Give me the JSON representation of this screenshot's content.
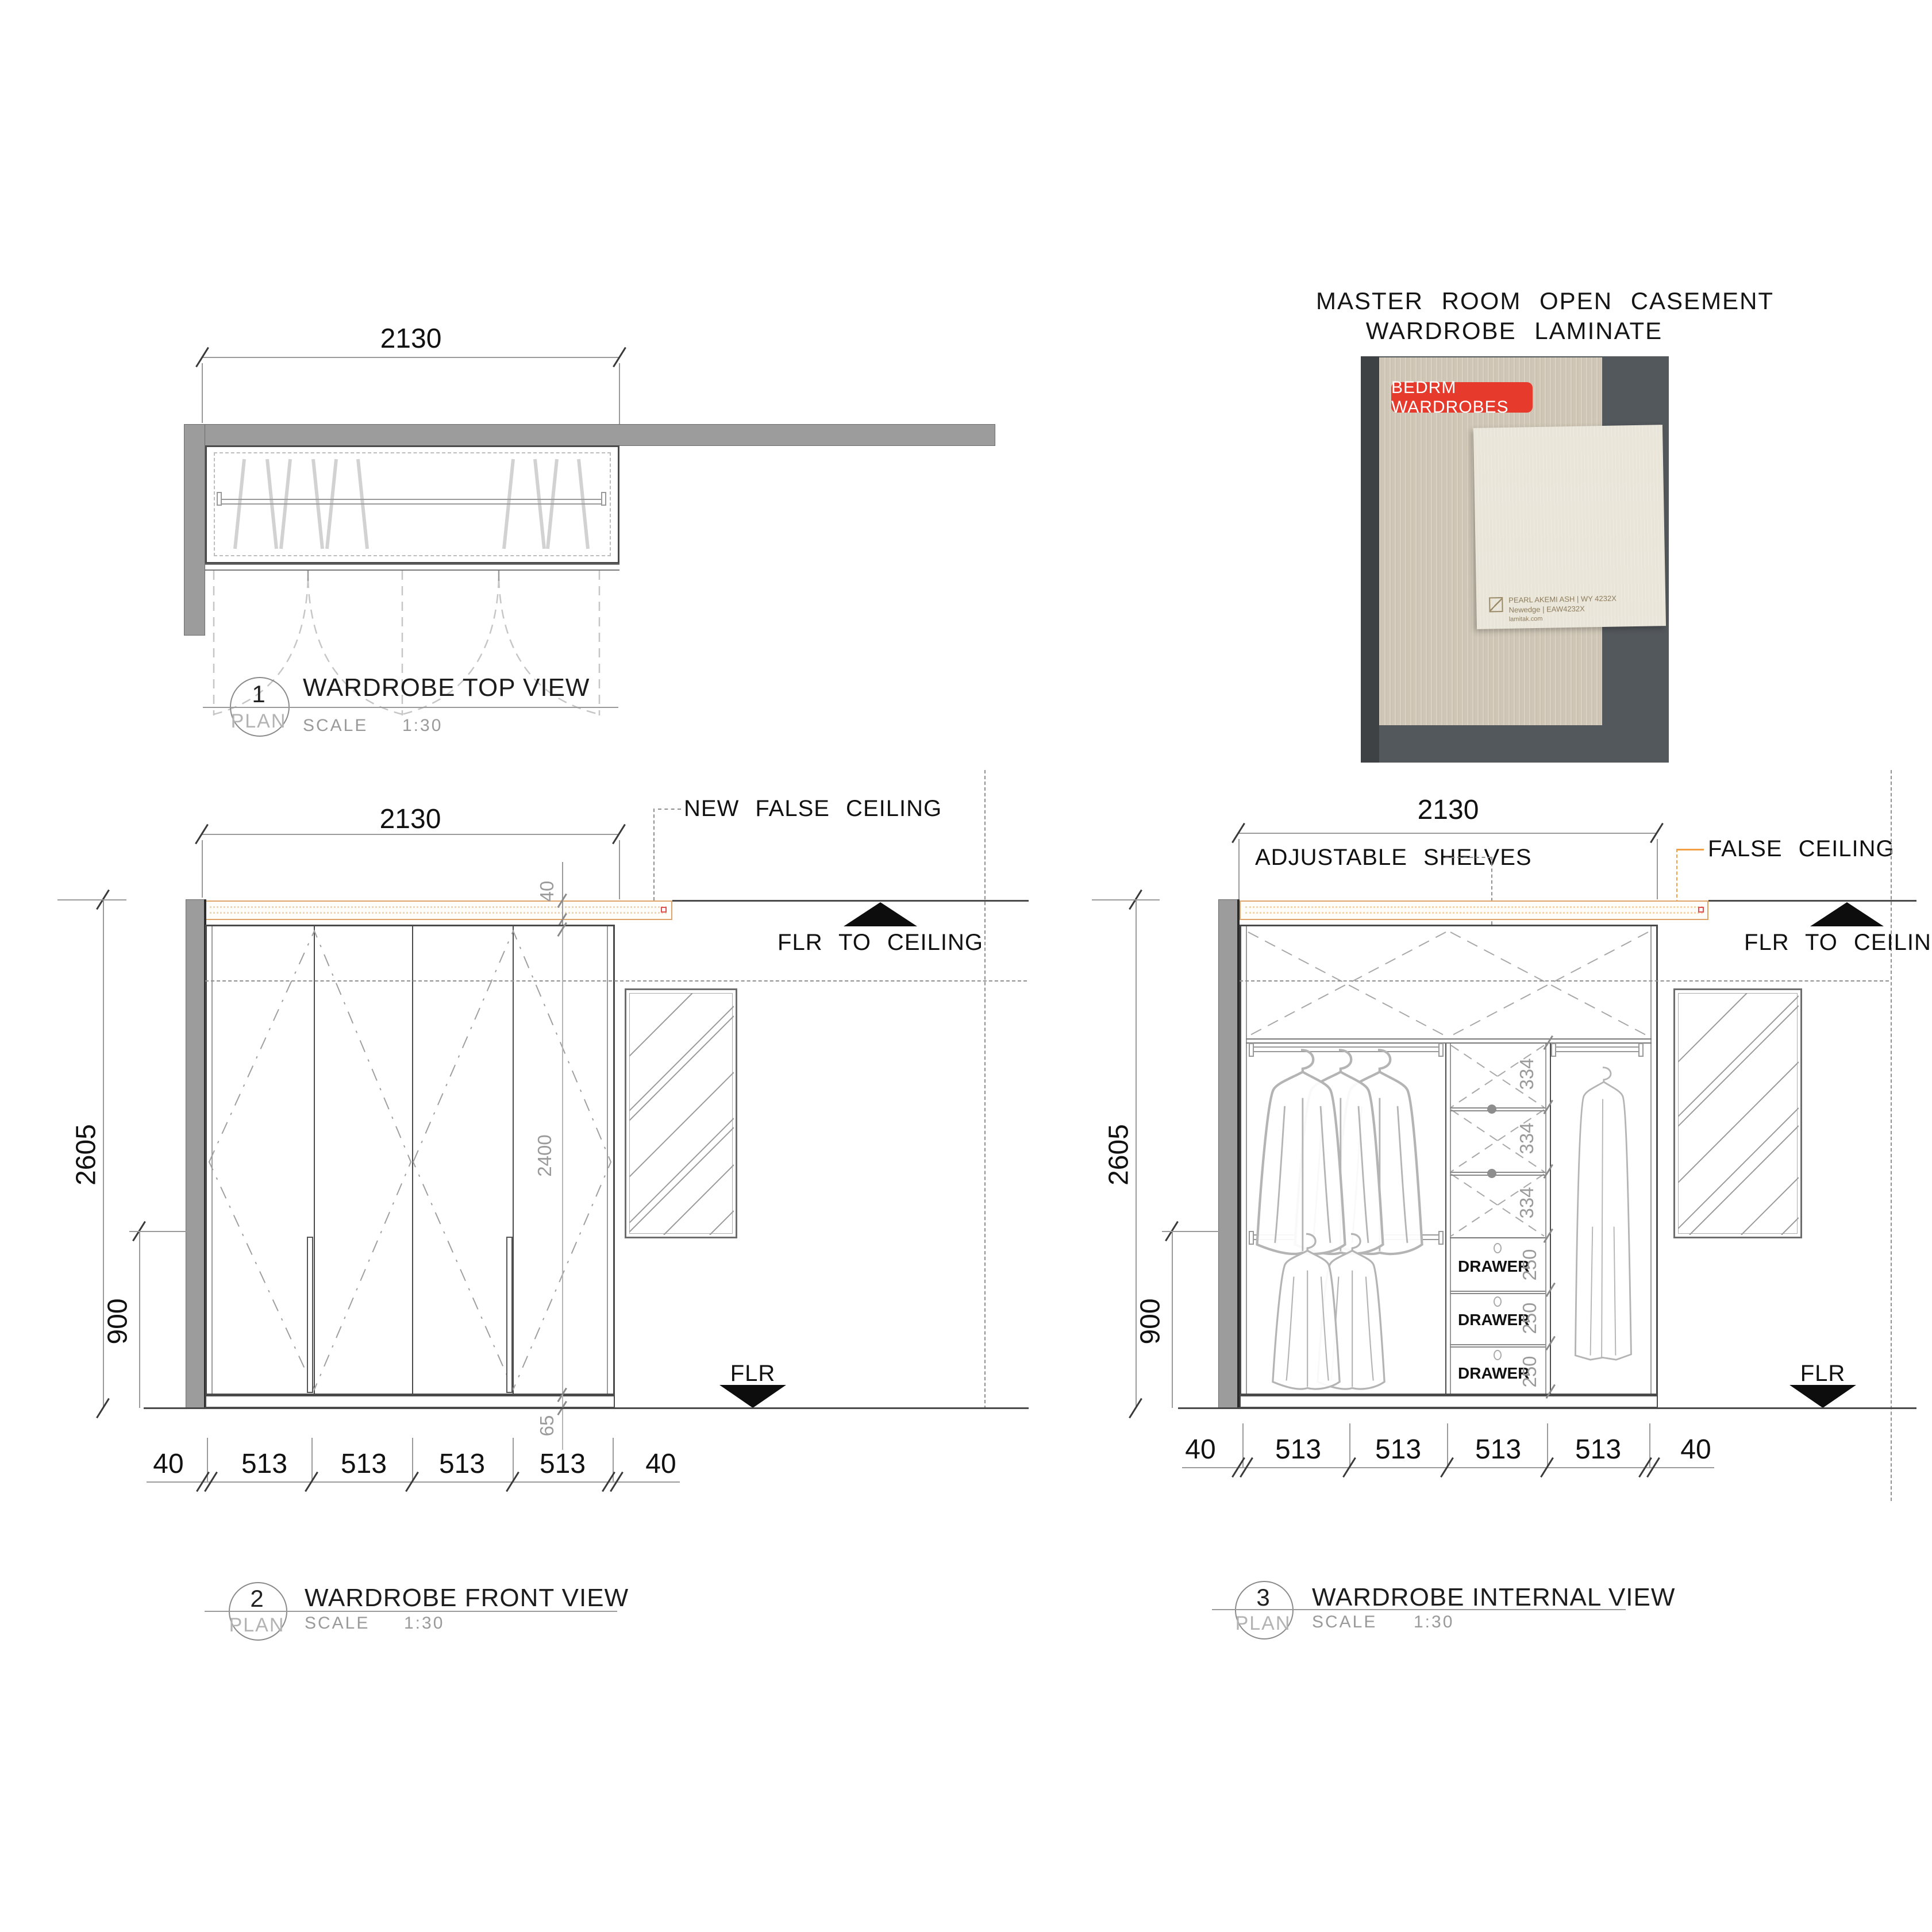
{
  "photo": {
    "title_line1": "MASTER ROOM OPEN CASEMENT",
    "title_line2": "WARDROBE LAMINATE",
    "badge": "BEDRM WARDROBES",
    "badge_color": "#e53a2c",
    "sample_line1": "PEARL AKEMI ASH | WY 4232X",
    "sample_line2": "Newedge | EAW4232X",
    "sample_line3": "lamitak.com"
  },
  "colors": {
    "accent_orange": "#f2952d",
    "band_border_orange": "#dfa468",
    "wall_gray": "#9c9c9c",
    "red_marker": "#e05050",
    "badge_red": "#e53a2c"
  },
  "top_view": {
    "number": "1",
    "plan_label": "PLAN",
    "title": "WARDROBE TOP VIEW",
    "scale_label": "SCALE",
    "scale_value": "1:30",
    "width_dim": "2130"
  },
  "front_view": {
    "number": "2",
    "plan_label": "PLAN",
    "title": "WARDROBE FRONT VIEW",
    "scale_label": "SCALE",
    "scale_value": "1:30",
    "width_dim": "2130",
    "height_dim": "2605",
    "rod_height_dim": "900",
    "ceiling_gap_dim": "40",
    "door_height_dim": "2400",
    "kick_dim": "65",
    "bottom_dims": [
      "40",
      "513",
      "513",
      "513",
      "513",
      "40"
    ],
    "ann_new_false_ceiling": "NEW FALSE CEILING",
    "ann_flr_to_ceiling": "FLR TO CEILING",
    "ann_flr": "FLR"
  },
  "internal_view": {
    "number": "3",
    "plan_label": "PLAN",
    "title": "WARDROBE INTERNAL VIEW",
    "scale_label": "SCALE",
    "scale_value": "1:30",
    "width_dim": "2130",
    "height_dim": "2605",
    "rod_height_dim": "900",
    "ann_adjustable_shelves": "ADJUSTABLE SHELVES",
    "ann_false_ceiling": "FALSE CEILING",
    "ann_flr_to_ceiling": "FLR TO CEILING",
    "ann_flr": "FLR",
    "shelf_dims": [
      "334",
      "334",
      "334"
    ],
    "drawer_labels": [
      "DRAWER",
      "DRAWER",
      "DRAWER"
    ],
    "drawer_dims": [
      "250",
      "250",
      "250"
    ],
    "bottom_dims": [
      "40",
      "513",
      "513",
      "513",
      "513",
      "40"
    ]
  }
}
